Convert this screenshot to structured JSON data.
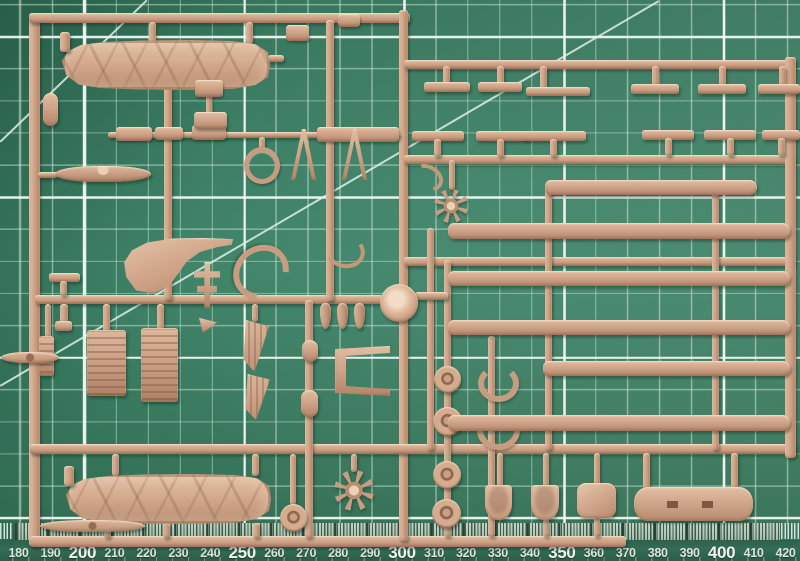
{
  "scene": {
    "description": "Photograph of a tan plastic model aircraft sprue (injection-molded parts tree) lying on a green self-healing cutting mat",
    "object": "model kit sprue, beige styrene",
    "surface": "cutting mat with 10 mm grid, 50 mm major grid, diagonal guides and mm ruler"
  },
  "colors": {
    "mat_green": "#3c8066",
    "mat_dark": "#2d6750",
    "grid_minor": "#cde4d9",
    "grid_major": "#f4fcf8",
    "plastic": "#cda185",
    "plastic_light": "#e4c3a8",
    "plastic_dark": "#a87c60",
    "tick_strip_bg": "#b8cdba",
    "tick_mark": "#1f4234",
    "ruler_number": "#e8eee8"
  },
  "ruler": {
    "unit": "mm",
    "start_x": 18.5,
    "step_px": 31.96,
    "major_every": 50,
    "labels": [
      "180",
      "190",
      "200",
      "210",
      "220",
      "230",
      "240",
      "250",
      "260",
      "270",
      "280",
      "290",
      "300",
      "310",
      "320",
      "330",
      "340",
      "350",
      "360",
      "370",
      "380",
      "390",
      "400",
      "410",
      "420"
    ]
  },
  "sprue": {
    "runners": [
      {
        "n": "frame-left",
        "b": [
          29,
          14,
          11,
          532
        ]
      },
      {
        "n": "frame-top",
        "b": [
          29,
          13,
          381,
          10
        ]
      },
      {
        "n": "frame-bottom",
        "b": [
          30,
          536,
          596,
          11
        ]
      },
      {
        "n": "center-vertical",
        "b": [
          399,
          10,
          9,
          531
        ]
      },
      {
        "n": "right-runner-1",
        "b": [
          404,
          60,
          391,
          9
        ]
      },
      {
        "n": "right-runner-2",
        "b": [
          404,
          155,
          391,
          9
        ]
      },
      {
        "n": "right-runner-3",
        "b": [
          404,
          257,
          391,
          9
        ]
      },
      {
        "n": "full-runner-4",
        "b": [
          30,
          444,
          766,
          10
        ]
      },
      {
        "n": "frame-right",
        "b": [
          785,
          57,
          11,
          401
        ]
      },
      {
        "n": "mid-left-runner",
        "b": [
          35,
          295,
          348,
          9
        ]
      },
      {
        "n": "sub-runner-left",
        "b": [
          108,
          132,
          292,
          6
        ]
      },
      {
        "n": "left-vertical-1",
        "b": [
          164,
          84,
          8,
          216
        ]
      },
      {
        "n": "left-vertical-2",
        "b": [
          326,
          20,
          8,
          281
        ]
      },
      {
        "n": "left-vertical-3",
        "b": [
          305,
          300,
          8,
          238
        ]
      },
      {
        "n": "wheels-vertical",
        "b": [
          444,
          260,
          7,
          277
        ]
      },
      {
        "n": "cowls-vertical",
        "b": [
          488,
          336,
          7,
          201
        ]
      },
      {
        "n": "float-connector-a",
        "b": [
          427,
          228,
          7,
          222
        ]
      },
      {
        "n": "float-connector-b",
        "b": [
          545,
          188,
          7,
          262
        ]
      },
      {
        "n": "float-connector-c",
        "b": [
          712,
          188,
          7,
          262
        ]
      },
      {
        "n": "gate-fus-top-1",
        "b": [
          149,
          22,
          7,
          22
        ]
      },
      {
        "n": "gate-fus-top-2",
        "b": [
          246,
          22,
          7,
          22
        ]
      },
      {
        "n": "stub-fus-nose",
        "b": [
          268,
          55,
          16,
          7
        ]
      },
      {
        "n": "stub-panels-nose",
        "b": [
          206,
          88,
          6,
          46
        ]
      },
      {
        "n": "gate-stab",
        "b": [
          38,
          172,
          20,
          6
        ]
      },
      {
        "n": "stub-ring",
        "b": [
          259,
          137,
          6,
          12
        ]
      },
      {
        "n": "gate-radiator-1",
        "b": [
          103,
          304,
          7,
          28
        ]
      },
      {
        "n": "gate-radiator-2",
        "b": [
          157,
          304,
          7,
          26
        ]
      },
      {
        "n": "gate-radiator-3",
        "b": [
          45,
          304,
          6,
          34
        ]
      },
      {
        "n": "gate-triangle",
        "b": [
          252,
          304,
          6,
          18
        ]
      },
      {
        "n": "bar-disc-right",
        "b": [
          415,
          292,
          33,
          8
        ]
      },
      {
        "n": "gate-engine-1",
        "b": [
          449,
          160,
          6,
          30
        ]
      },
      {
        "n": "gate-bigpanel-1",
        "b": [
          643,
          453,
          7,
          36
        ]
      },
      {
        "n": "gate-bigpanel-2",
        "b": [
          731,
          453,
          7,
          36
        ]
      },
      {
        "n": "gate-seat-1",
        "b": [
          497,
          453,
          6,
          34
        ]
      },
      {
        "n": "gate-seat-2",
        "b": [
          543,
          453,
          6,
          34
        ]
      },
      {
        "n": "gate-pad",
        "b": [
          594,
          453,
          6,
          32
        ]
      },
      {
        "n": "gate-seat-1b",
        "b": [
          543,
          519,
          6,
          18
        ]
      },
      {
        "n": "gate-pad-b",
        "b": [
          594,
          517,
          6,
          20
        ]
      },
      {
        "n": "gate-wheel-disc",
        "b": [
          290,
          454,
          6,
          51
        ]
      },
      {
        "n": "gate-engine-2",
        "b": [
          351,
          454,
          6,
          18
        ]
      },
      {
        "n": "gate-fus-bot-1",
        "b": [
          112,
          454,
          7,
          22
        ]
      },
      {
        "n": "gate-fus-bot-2",
        "b": [
          252,
          454,
          7,
          22
        ]
      },
      {
        "n": "gate-fus-bot-3",
        "b": [
          163,
          523,
          7,
          15
        ]
      },
      {
        "n": "gate-fus-bot-4",
        "b": [
          253,
          523,
          7,
          15
        ]
      },
      {
        "n": "gate-prop",
        "b": [
          104,
          528,
          7,
          10
        ]
      },
      {
        "n": "stand-foot-mid",
        "b": [
          49,
          273,
          31,
          9
        ]
      },
      {
        "n": "stand-stem-mid",
        "b": [
          60,
          281,
          7,
          15
        ]
      },
      {
        "n": "hang-stem-mid",
        "b": [
          60,
          304,
          8,
          19
        ]
      },
      {
        "n": "hang-blob-mid",
        "b": [
          55,
          321,
          17,
          10
        ]
      },
      {
        "n": "hangT-stem-1",
        "b": [
          443,
          66,
          7,
          20
        ]
      },
      {
        "n": "hangT-stem-2",
        "b": [
          497,
          66,
          7,
          20
        ]
      },
      {
        "n": "hangT-stem-3",
        "b": [
          540,
          66,
          7,
          24
        ]
      },
      {
        "n": "hangT-stem-4",
        "b": [
          652,
          66,
          7,
          20
        ]
      },
      {
        "n": "hangT-stem-5",
        "b": [
          719,
          66,
          7,
          20
        ]
      },
      {
        "n": "hangT-stem-6",
        "b": [
          779,
          66,
          7,
          20
        ]
      },
      {
        "n": "hangT-foot-1",
        "b": [
          424,
          82,
          46,
          10
        ]
      },
      {
        "n": "hangT-foot-2",
        "b": [
          478,
          82,
          44,
          10
        ]
      },
      {
        "n": "hangT-foot-3",
        "b": [
          526,
          87,
          64,
          9
        ]
      },
      {
        "n": "hangT-foot-4",
        "b": [
          631,
          84,
          48,
          10
        ]
      },
      {
        "n": "hangT-foot-5",
        "b": [
          698,
          84,
          48,
          10
        ]
      },
      {
        "n": "hangT-foot-6",
        "b": [
          758,
          84,
          42,
          10
        ]
      },
      {
        "n": "standT-foot-1",
        "b": [
          412,
          131,
          52,
          10
        ]
      },
      {
        "n": "standT-foot-2",
        "b": [
          476,
          131,
          52,
          10
        ]
      },
      {
        "n": "standT-foot-3",
        "b": [
          524,
          131,
          62,
          10
        ]
      },
      {
        "n": "standT-foot-4",
        "b": [
          642,
          130,
          52,
          10
        ]
      },
      {
        "n": "standT-foot-5",
        "b": [
          704,
          130,
          52,
          10
        ]
      },
      {
        "n": "standT-foot-6",
        "b": [
          762,
          130,
          38,
          10
        ]
      },
      {
        "n": "standT-stem-1",
        "b": [
          434,
          139,
          7,
          18
        ]
      },
      {
        "n": "standT-stem-2",
        "b": [
          497,
          139,
          7,
          18
        ]
      },
      {
        "n": "standT-stem-3",
        "b": [
          550,
          139,
          7,
          18
        ]
      },
      {
        "n": "standT-stem-4",
        "b": [
          665,
          138,
          7,
          18
        ]
      },
      {
        "n": "standT-stem-5",
        "b": [
          727,
          138,
          7,
          18
        ]
      },
      {
        "n": "standT-stem-6",
        "b": [
          778,
          138,
          7,
          18
        ]
      }
    ],
    "parts": [
      {
        "n": "fuselage-half-top",
        "s": "fus",
        "b": [
          62,
          40,
          208,
          50
        ]
      },
      {
        "n": "tail-tab-top",
        "b": [
          60,
          32,
          10,
          20
        ]
      },
      {
        "n": "fuselage-half-bottom",
        "s": "fus",
        "b": [
          66,
          474,
          205,
          50
        ]
      },
      {
        "n": "tail-tab-bottom",
        "b": [
          64,
          466,
          10,
          20
        ]
      },
      {
        "n": "propeller-two-blade",
        "s": "prop",
        "b": [
          40,
          520,
          105,
          12
        ]
      },
      {
        "n": "stabilizer",
        "s": "stab",
        "b": [
          55,
          166,
          96,
          16
        ]
      },
      {
        "n": "panel-small-a",
        "s": "panel",
        "b": [
          116,
          127,
          36,
          14
        ]
      },
      {
        "n": "panel-small-b",
        "s": "panel",
        "b": [
          155,
          127,
          28,
          13
        ]
      },
      {
        "n": "panel-small-c",
        "s": "panel",
        "b": [
          192,
          125,
          34,
          15
        ]
      },
      {
        "n": "panel-wide",
        "s": "panel",
        "b": [
          317,
          127,
          82,
          15
        ]
      },
      {
        "n": "panel-nose-upper",
        "s": "panel",
        "b": [
          195,
          80,
          28,
          17
        ]
      },
      {
        "n": "panel-nose-lower",
        "s": "panel",
        "b": [
          194,
          112,
          33,
          17
        ]
      },
      {
        "n": "pill-left-frame",
        "s": "pill",
        "b": [
          43,
          93,
          15,
          33
        ]
      },
      {
        "n": "ring-part",
        "s": "ring",
        "b": [
          244,
          147,
          26,
          27
        ]
      },
      {
        "n": "a-frame-strut-1",
        "s": "aframe",
        "b": [
          291,
          129,
          25,
          51
        ]
      },
      {
        "n": "a-frame-strut-2",
        "s": "aframe",
        "b": [
          342,
          129,
          25,
          51
        ]
      },
      {
        "n": "bracket-top-a",
        "s": "panel",
        "b": [
          286,
          25,
          23,
          16
        ]
      },
      {
        "n": "bracket-top-b",
        "s": "panel",
        "b": [
          338,
          14,
          22,
          13
        ]
      },
      {
        "n": "curved-fin",
        "s": "fin",
        "b": [
          123,
          238,
          110,
          56
        ]
      },
      {
        "n": "c-ring-large",
        "s": "cring",
        "b": [
          232,
          246,
          46,
          40
        ],
        "r": 140
      },
      {
        "n": "hook-strut",
        "s": "hook",
        "b": [
          325,
          234,
          32,
          26
        ],
        "r": 15
      },
      {
        "n": "cross-part",
        "s": "cross",
        "b": [
          194,
          262,
          26,
          46
        ]
      },
      {
        "n": "wedge-part",
        "s": "wedge",
        "b": [
          199,
          318,
          18,
          15
        ]
      },
      {
        "n": "radiator-1",
        "s": "rib",
        "b": [
          87,
          330,
          39,
          66
        ]
      },
      {
        "n": "radiator-2",
        "s": "rib",
        "b": [
          141,
          328,
          37,
          74
        ]
      },
      {
        "n": "radiator-3",
        "s": "rib",
        "b": [
          39,
          336,
          15,
          40
        ]
      },
      {
        "n": "blade-left-edge",
        "s": "blade",
        "b": [
          1,
          352,
          58,
          11
        ]
      },
      {
        "n": "triangle-panel-1",
        "s": "tri",
        "b": [
          242,
          320,
          27,
          52
        ]
      },
      {
        "n": "triangle-panel-2",
        "s": "tri",
        "b": [
          244,
          374,
          26,
          46
        ]
      },
      {
        "n": "cylinder-1",
        "s": "pill",
        "b": [
          302,
          340,
          16,
          22
        ]
      },
      {
        "n": "cylinder-2",
        "s": "pill",
        "b": [
          301,
          390,
          17,
          27
        ]
      },
      {
        "n": "v-bracket",
        "s": "vbracket",
        "b": [
          335,
          346,
          55,
          50
        ]
      },
      {
        "n": "bomb-1",
        "s": "bomb",
        "b": [
          320,
          303,
          11,
          26
        ]
      },
      {
        "n": "bomb-2",
        "s": "bomb",
        "b": [
          337,
          303,
          11,
          26
        ]
      },
      {
        "n": "bomb-3",
        "s": "bomb",
        "b": [
          354,
          303,
          11,
          26
        ]
      },
      {
        "n": "pour-disc-center",
        "s": "disc",
        "b": [
          380,
          284,
          38,
          38
        ]
      },
      {
        "n": "radial-engine-1",
        "s": "star",
        "b": [
          434,
          189,
          34,
          34
        ]
      },
      {
        "n": "hook-small",
        "s": "hook",
        "b": [
          415,
          161,
          17,
          25
        ],
        "r": -60
      },
      {
        "n": "radial-engine-2",
        "s": "star",
        "b": [
          334,
          470,
          40,
          41
        ]
      },
      {
        "n": "wheel-1",
        "s": "wheel",
        "b": [
          434,
          366,
          27,
          27
        ]
      },
      {
        "n": "wheel-2",
        "s": "wheel",
        "b": [
          433,
          407,
          29,
          29
        ]
      },
      {
        "n": "wheel-3",
        "s": "wheel",
        "b": [
          433,
          461,
          28,
          28
        ]
      },
      {
        "n": "wheel-4",
        "s": "wheel",
        "b": [
          432,
          499,
          29,
          29
        ]
      },
      {
        "n": "cowl-c-1",
        "s": "cring",
        "b": [
          478,
          365,
          29,
          25
        ]
      },
      {
        "n": "cowl-c-2",
        "s": "cring",
        "b": [
          477,
          411,
          31,
          27
        ]
      },
      {
        "n": "wheel-disc-spiral",
        "s": "wheel",
        "b": [
          280,
          504,
          27,
          28
        ]
      },
      {
        "n": "seat-1",
        "s": "seat",
        "b": [
          485,
          485,
          27,
          35
        ]
      },
      {
        "n": "seat-2",
        "s": "seat",
        "b": [
          531,
          485,
          28,
          35
        ]
      },
      {
        "n": "pad-square",
        "s": "padsq",
        "b": [
          577,
          483,
          39,
          35
        ]
      },
      {
        "n": "wing-center-panel",
        "s": "bigpanel",
        "b": [
          634,
          487,
          119,
          34
        ]
      },
      {
        "n": "float-long-1",
        "s": "float",
        "b": [
          545,
          180,
          212,
          15
        ]
      },
      {
        "n": "float-long-2",
        "s": "float",
        "b": [
          448,
          223,
          342,
          16
        ]
      },
      {
        "n": "float-long-3",
        "s": "float",
        "b": [
          448,
          271,
          342,
          15
        ]
      },
      {
        "n": "float-long-4",
        "s": "float",
        "b": [
          448,
          320,
          342,
          15
        ]
      },
      {
        "n": "float-long-5",
        "s": "float",
        "b": [
          543,
          361,
          247,
          15
        ]
      },
      {
        "n": "float-long-6",
        "s": "float",
        "b": [
          448,
          415,
          342,
          16
        ]
      }
    ]
  }
}
